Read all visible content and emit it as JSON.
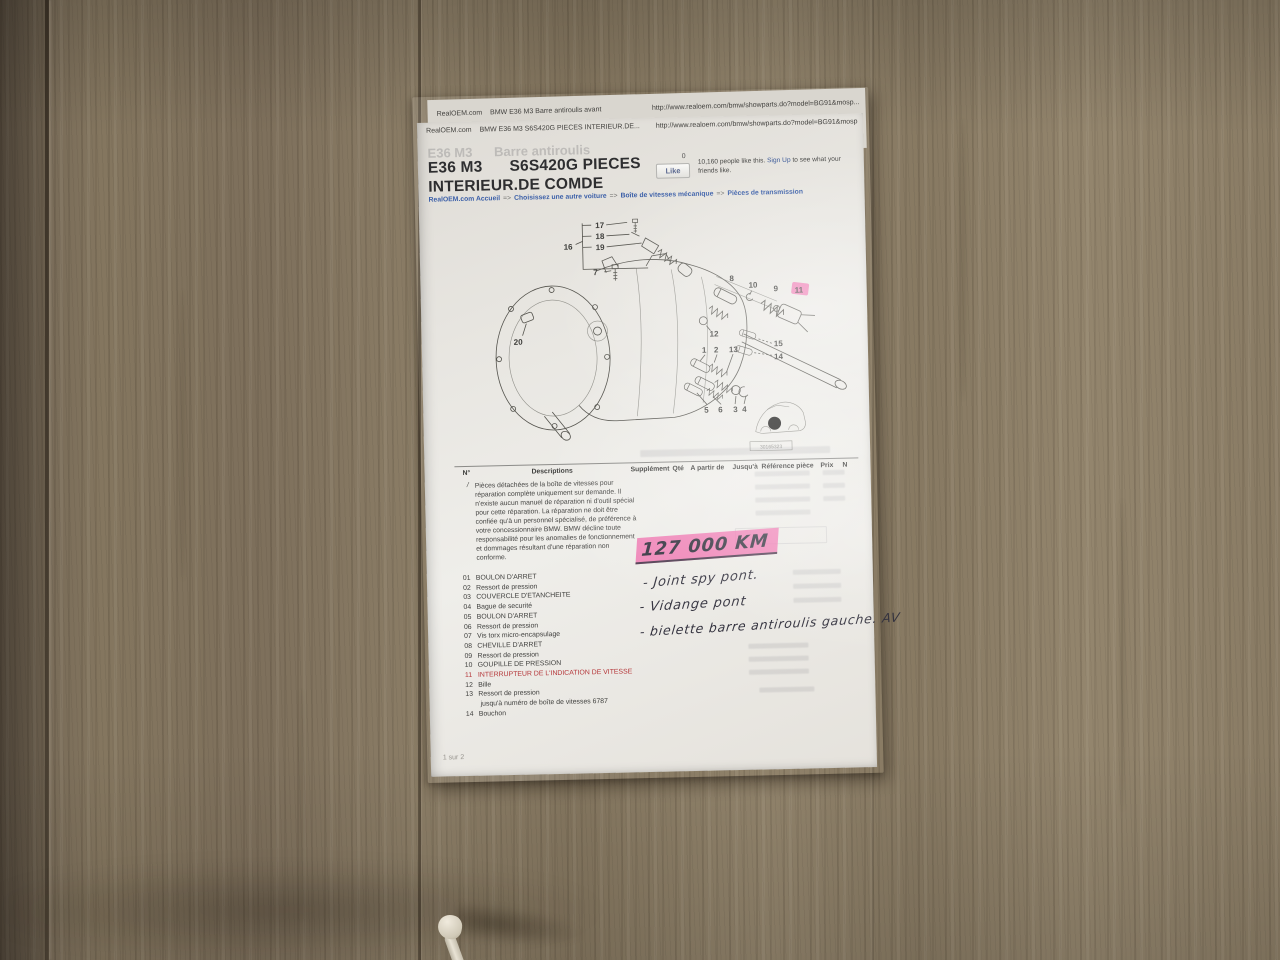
{
  "doc": {
    "back_sheet": {
      "site": "RealOEM.com",
      "title": "BMW E36 M3 Barre antiroulis avant",
      "url": "http://www.realoem.com/bmw/showparts.do?model=BG91&mosp..."
    },
    "header": {
      "site": "RealOEM.com",
      "title": "BMW E36 M3 S6S420G PIECES INTERIEUR.DE...",
      "url": "http://www.realoem.com/bmw/showparts.do?model=BG91&mosp"
    },
    "ghost_title": "E36 M3      Barre antiroulis",
    "title_line1": "E36 M3      S6S420G PIECES",
    "title_line2": "INTERIEUR.DE COMDE",
    "facebook": {
      "count": "0",
      "like_label": "Like",
      "text_before": "10,160 people like this. ",
      "sign_up": "Sign Up",
      "text_after": " to see what your friends like."
    },
    "breadcrumb": [
      {
        "label": "RealOEM.com Accueil"
      },
      {
        "label": "Choisissez une autre voiture"
      },
      {
        "label": "Boîte de vitesses mécanique"
      },
      {
        "label": "Pièces de transmission"
      }
    ],
    "breadcrumb_separator": "=>",
    "diagram": {
      "callouts": [
        "17",
        "18",
        "19",
        "16",
        "7",
        "20",
        "8",
        "10",
        "9",
        "11",
        "12",
        "1",
        "2",
        "13",
        "15",
        "14",
        "5",
        "6",
        "3",
        "4"
      ],
      "image_id": "30165323",
      "highlight_color": "#f06fae"
    },
    "table": {
      "headers": [
        "N°",
        "Descriptions",
        "Supplément",
        "Qté",
        "A partir de",
        "Jusqu'à",
        "Référence pièce",
        "Prix",
        "N"
      ],
      "notice_marker": "/",
      "notice": "Pièces détachées de la boîte de vitesses pour réparation complète uniquement sur demande. Il n'existe aucun manuel de réparation ni d'outil spécial pour cette réparation. La réparation ne doit être confiée qu'à un personnel spécialisé, de préférence à votre concessionnaire BMW. BMW décline toute responsabilité pour les anomalies de fonctionnement et dommages résultant d'une réparation non conforme.",
      "rows": [
        {
          "num": "01",
          "desc": "BOULON D'ARRET"
        },
        {
          "num": "02",
          "desc": "Ressort de pression"
        },
        {
          "num": "03",
          "desc": "COUVERCLE D'ETANCHEITE"
        },
        {
          "num": "04",
          "desc": "Bague de securité"
        },
        {
          "num": "05",
          "desc": "BOULON D'ARRET"
        },
        {
          "num": "06",
          "desc": "Ressort de pression"
        },
        {
          "num": "07",
          "desc": "Vis torx micro-encapsulage"
        },
        {
          "num": "08",
          "desc": "CHEVILLE D'ARRET"
        },
        {
          "num": "09",
          "desc": "Ressort de pression"
        },
        {
          "num": "10",
          "desc": "GOUPILLE DE PRESSION"
        },
        {
          "num": "11",
          "desc": "INTERRUPTEUR DE L'INDICATION DE VITESSE"
        },
        {
          "num": "12",
          "desc": "Bille"
        },
        {
          "num": "13",
          "desc": "Ressort de pression",
          "sub": "jusqu'à numéro de boîte de vitesses 6787"
        },
        {
          "num": "14",
          "desc": "Bouchon"
        }
      ]
    },
    "handwriting": {
      "mileage": "127 000 KM",
      "note1": "- Joint spy pont.",
      "note2": "- Vidange pont",
      "note3": "- bielette barre antiroulis gauche. AV",
      "ink_color": "#34333f",
      "highlight_color": "#f06fae"
    },
    "footer": "1 sur 2",
    "colors": {
      "link_blue": "#3b5fa8",
      "warning_red": "#b5373a",
      "paper": "#e8e6e1"
    }
  }
}
